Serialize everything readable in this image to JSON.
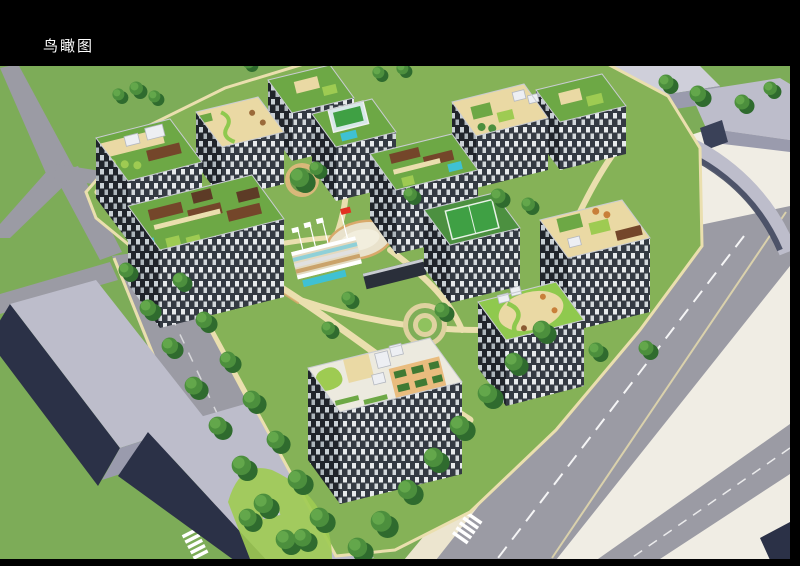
{
  "header": {
    "title": "鸟瞰图",
    "title_color": "#ffffff"
  },
  "palette": {
    "ink": "#000000",
    "titleColor": "#ffffff",
    "grass": "#7dac58",
    "road": "#9b9ba4",
    "sidewalk": "#ece5cf",
    "plaza": "#f0ede4",
    "ctxRoof": "#bdbdcb",
    "ctxRoofLight": "#cfcfda",
    "ctxFace": "#9a9bad",
    "ctxDark": "#3a4158",
    "slabDark": "#2b3147",
    "lawn": "#85b257",
    "lawnBright": "#9ecb52",
    "pathCream": "#eadfae",
    "pathTan": "#d9a96b",
    "roofGreen": "#6da845",
    "roofGreenBright": "#8fc94e",
    "sand": "#ead9a4",
    "soil": "#5d3b26",
    "pergola": "#74462a",
    "pool": "#3fc1d3",
    "glass": "#d7e8e8",
    "court": "#3fa044",
    "treeDark": "#2f6b2e",
    "treeMid": "#4c8f3d",
    "treeLight": "#63a74b",
    "flagRed": "#e23222",
    "white": "#ffffff",
    "facadeLight": "#343a43",
    "windowLight": "#e7eaec",
    "windowLight2": "#d3d8db",
    "facadeDark": "#20242b",
    "windowDark": "#c9d0d5",
    "windowDark2": "#aeb6bc"
  }
}
